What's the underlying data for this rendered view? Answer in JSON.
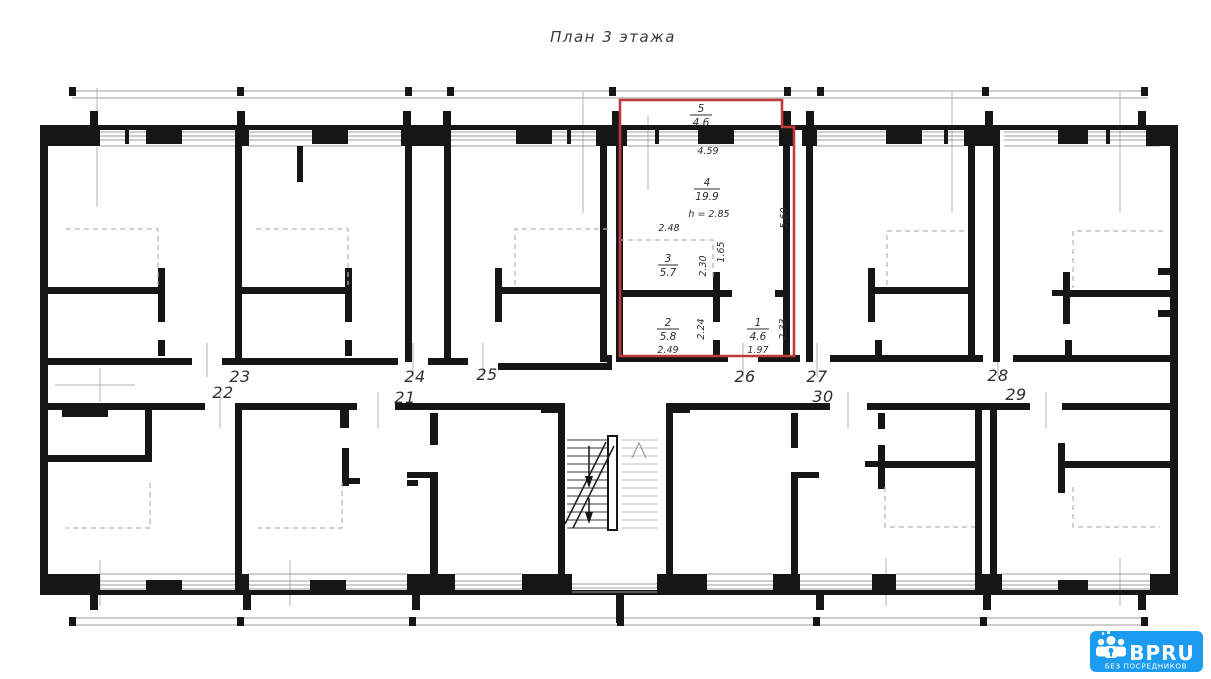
{
  "title": "План 3 этажа",
  "plan": {
    "apartment_numbers": [
      {
        "label": "21"
      },
      {
        "label": "22"
      },
      {
        "label": "23"
      },
      {
        "label": "24"
      },
      {
        "label": "25"
      },
      {
        "label": "26"
      },
      {
        "label": "27"
      },
      {
        "label": "28"
      },
      {
        "label": "29"
      },
      {
        "label": "30"
      }
    ]
  },
  "highlighted_apartment": {
    "outline_color": "#c13b3b",
    "rooms": [
      {
        "number": "1",
        "area": "4.6"
      },
      {
        "number": "2",
        "area": "5.8"
      },
      {
        "number": "3",
        "area": "5.7"
      },
      {
        "number": "4",
        "area": "19.9"
      },
      {
        "number": "5",
        "area": "4.6"
      }
    ],
    "ceiling_height": "h = 2.85",
    "dimensions": {
      "balcony_width": "4.59",
      "room4_width": "2.48",
      "room2_width": "2.49",
      "room1_width": "1.97",
      "depth": "5.60",
      "hall_width": "1.65",
      "room3_depth": "2.30",
      "room2_depth": "2.24",
      "room1_depth": "2.33"
    }
  },
  "watermark": {
    "brand": "BPRU",
    "tagline": "БЕЗ ПОСРЕДНИКОВ",
    "background": "#1b9cf0"
  }
}
